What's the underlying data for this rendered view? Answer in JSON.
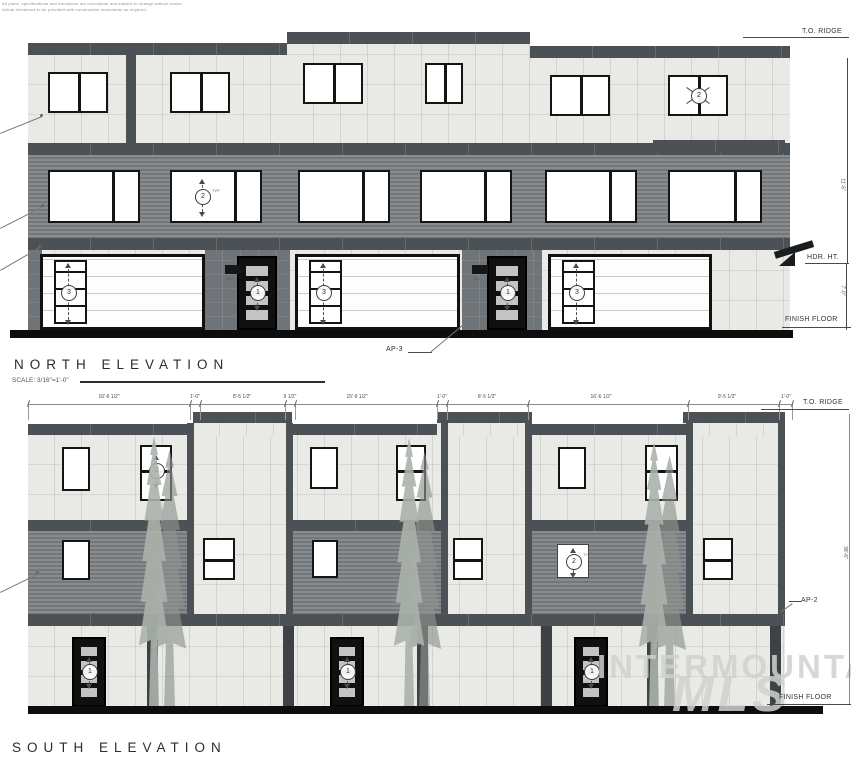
{
  "disclaimer": {
    "line1": "All plans, specifications and elevations are conceptual and subject to change without notice.",
    "line2": "Actual elevations to be provided with construction documents as required."
  },
  "watermark": {
    "line1": "INTERMOUNTAIN",
    "line2": "MLS"
  },
  "north": {
    "title": "NORTH ELEVATION",
    "scale": "SCALE: 3/16\"=1'-0\"",
    "to_ridge": "T.O. RIDGE",
    "hdr_ht": "HDR. HT.",
    "finish_floor": "FINISH FLOOR",
    "ap_label": "AP-3",
    "dim_upper": "11'-6\"",
    "dim_lower": "7'-0\"",
    "address": "123"
  },
  "south": {
    "title": "SOUTH ELEVATION",
    "to_ridge": "T.O. RIDGE",
    "finish_floor": "FINISH FLOOR",
    "ap_label": "AP-2",
    "dim_height": "38'-6\"",
    "dims": [
      "16'-6 1/2\"",
      "1'-0\"",
      "8'-5 1/2\"",
      "9 1/2\"",
      "15'-9 1/2\"",
      "1'-0\"",
      "8'-5 1/2\"",
      "16'-6 1/2\"",
      "9'-5 1/2\"",
      "1'-0\""
    ]
  },
  "symbols": {
    "entry_door": "1",
    "window": "2",
    "garage_door": "3",
    "typ_mark": "TYP"
  }
}
